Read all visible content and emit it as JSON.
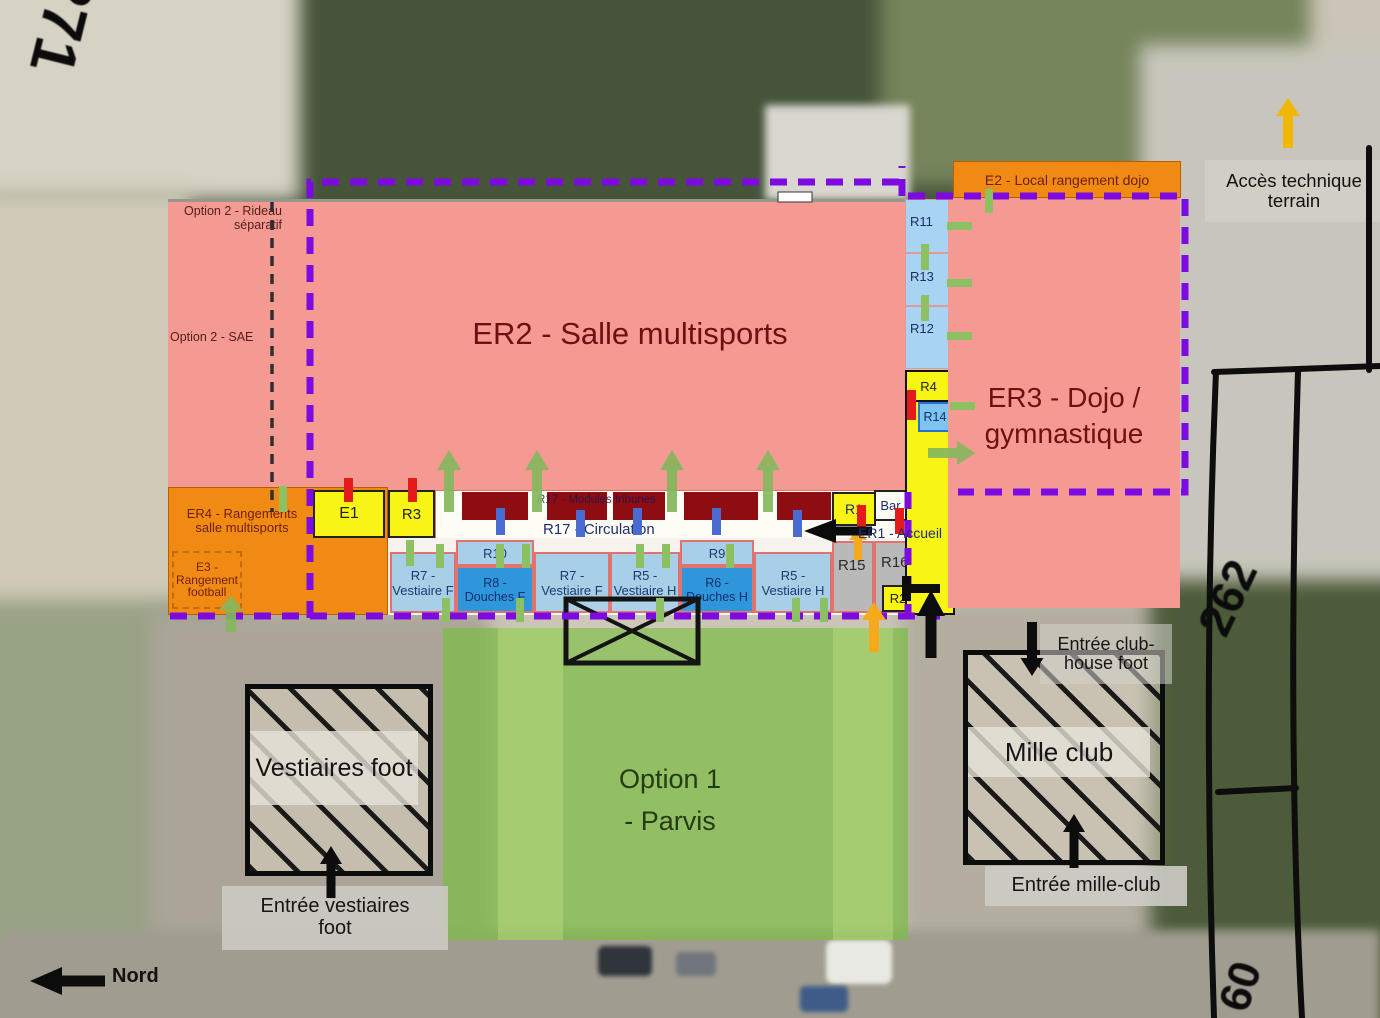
{
  "palette": {
    "pink": "#f49a93",
    "orange": "#f08a12",
    "yellow": "#f8f414",
    "light_blue": "#a7cfe8",
    "medium_blue": "#2f96db",
    "pale_blue": "#a9d3f2",
    "gray_room": "#b9b9b9",
    "maroon_module": "#8e0d12",
    "purple_dash": "#7d0ae0",
    "green_door": "#8cc063",
    "red_door": "#e31b1b",
    "blue_door": "#4a6cd0",
    "parvis_green": "#7dbd42",
    "label_dark_red": "#6e1012",
    "label_navy": "#1d2f6e"
  },
  "parcels": {
    "top_left": "271",
    "right": "262",
    "bottom_right": "60"
  },
  "compass": {
    "label": "Nord"
  },
  "plan": {
    "er2_label": "ER2 - Salle multisports",
    "er3_label_line1": "ER3 - Dojo /",
    "er3_label_line2": "gymnastique",
    "e2_label": "E2 - Local rangement dojo",
    "er4_label": "ER4 - Rangements salle multisports",
    "e3_label": "E3 - Rangement football",
    "option2_rideau": "Option 2 - Rideau séparatif",
    "option2_sae": "Option 2 - SAE",
    "modules_label": "R17 - Modules tribunes",
    "circulation_label": "R17 - Circulation",
    "rooms": {
      "e1": "E1",
      "r3": "R3",
      "r1": "R1",
      "bar": "Bar",
      "er1_accueil": "ER1 - Accueil",
      "r2": "R2",
      "r4": "R4",
      "r14": "R14",
      "r11": "R11",
      "r13": "R13",
      "r12": "R12",
      "r15": "R15",
      "r16": "R16",
      "r10": "R10",
      "r9": "R9",
      "r7_vestiaire_f_1": "R7 - Vestiaire F",
      "r8_douches_f": "R8 - Douches F",
      "r7_vestiaire_f_2": "R7 - Vestiaire F",
      "r5_vestiaire_h_1": "R5 - Vestiaire H",
      "r6_douches_h": "R6 - Douches H",
      "r5_vestiaire_h_2": "R5 - Vestiaire H"
    }
  },
  "site": {
    "option1_line1": "Option 1",
    "option1_line2": "- Parvis",
    "vestiaires_foot": "Vestiaires foot",
    "mille_club": "Mille club",
    "acces_technique": "Accès technique terrain",
    "entree_vestiaires_foot": "Entrée vestiaires foot",
    "entree_club_house": "Entrée club- house foot",
    "entree_mille_club": "Entrée mille-club"
  }
}
